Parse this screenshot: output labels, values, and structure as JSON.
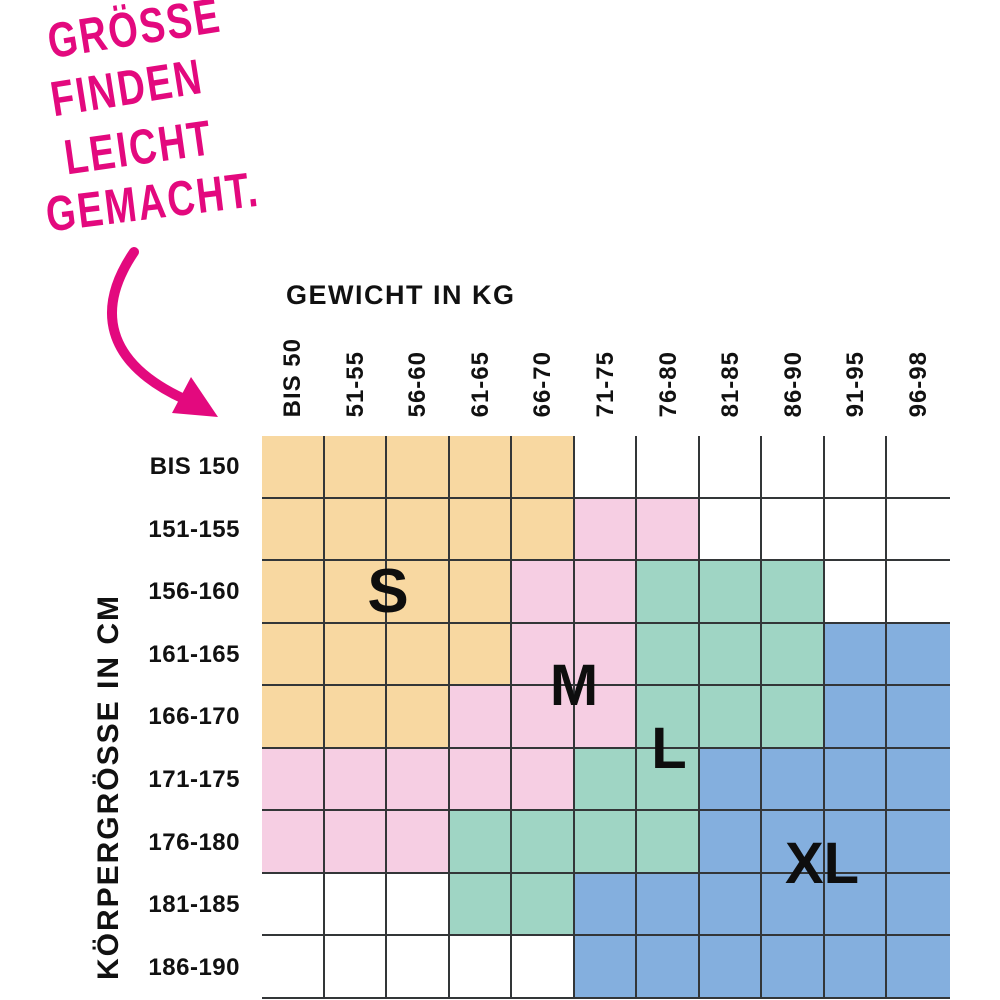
{
  "headline": {
    "lines": [
      "GRÖSSE",
      "FINDEN",
      "LEICHT",
      "GEMACHT."
    ],
    "color": "#E3097E",
    "arrow_icon": "curved-arrow-down-right"
  },
  "chart_data": {
    "type": "heatmap",
    "title": "GRÖSSE FINDEN LEICHT GEMACHT.",
    "xlabel": "GEWICHT IN KG",
    "ylabel": "KÖRPERGRÖSSE IN CM",
    "x_categories": [
      "BIS 50",
      "51-55",
      "56-60",
      "61-65",
      "66-70",
      "71-75",
      "76-80",
      "81-85",
      "86-90",
      "91-95",
      "96-98"
    ],
    "y_categories": [
      "BIS 150",
      "151-155",
      "156-160",
      "161-165",
      "166-170",
      "171-175",
      "176-180",
      "181-185",
      "186-190"
    ],
    "grid": [
      [
        "S",
        "S",
        "S",
        "S",
        "S",
        "",
        "",
        "",
        "",
        "",
        ""
      ],
      [
        "S",
        "S",
        "S",
        "S",
        "S",
        "M",
        "M",
        "",
        "",
        "",
        ""
      ],
      [
        "S",
        "S",
        "S",
        "S",
        "M",
        "M",
        "L",
        "L",
        "L",
        "",
        ""
      ],
      [
        "S",
        "S",
        "S",
        "S",
        "M",
        "M",
        "L",
        "L",
        "L",
        "XL",
        "XL"
      ],
      [
        "S",
        "S",
        "S",
        "M",
        "M",
        "M",
        "L",
        "L",
        "L",
        "XL",
        "XL"
      ],
      [
        "M",
        "M",
        "M",
        "M",
        "M",
        "L",
        "L",
        "XL",
        "XL",
        "XL",
        "XL"
      ],
      [
        "M",
        "M",
        "M",
        "L",
        "L",
        "L",
        "L",
        "XL",
        "XL",
        "XL",
        "XL"
      ],
      [
        "",
        "",
        "",
        "L",
        "L",
        "XL",
        "XL",
        "XL",
        "XL",
        "XL",
        "XL"
      ],
      [
        "",
        "",
        "",
        "",
        "",
        "XL",
        "XL",
        "XL",
        "XL",
        "XL",
        "XL"
      ]
    ],
    "size_labels": [
      "S",
      "M",
      "L",
      "XL"
    ],
    "legend": {
      "S": "#F8D8A1",
      "M": "#F6CEE3",
      "L": "#9FD5C4",
      "XL": "#84AFDE"
    },
    "empty_color": "#FFFFFF",
    "grid_line_color": "#333638",
    "grid_lines": true,
    "legend_position": "in-grid"
  },
  "colors": {
    "accent_pink": "#E3097E",
    "text": "#111111"
  }
}
